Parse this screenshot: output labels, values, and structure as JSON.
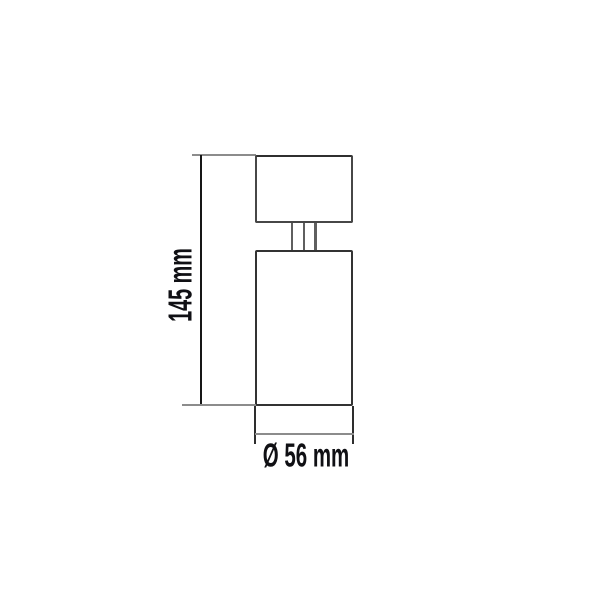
{
  "diagram": {
    "type": "product-dimension-drawing",
    "subject": "cylindrical ceiling spotlight, side view",
    "dimensions": {
      "height": {
        "label": "145 mm",
        "value": 145,
        "unit": "mm"
      },
      "diameter": {
        "label": "Ø 56 mm",
        "value": 56,
        "unit": "mm"
      }
    },
    "colors": {
      "background": "#ffffff",
      "object_line": "#474747",
      "dimension_line": "#161616",
      "extension_line": "#8c8c8c",
      "label_text": "#101014"
    }
  }
}
